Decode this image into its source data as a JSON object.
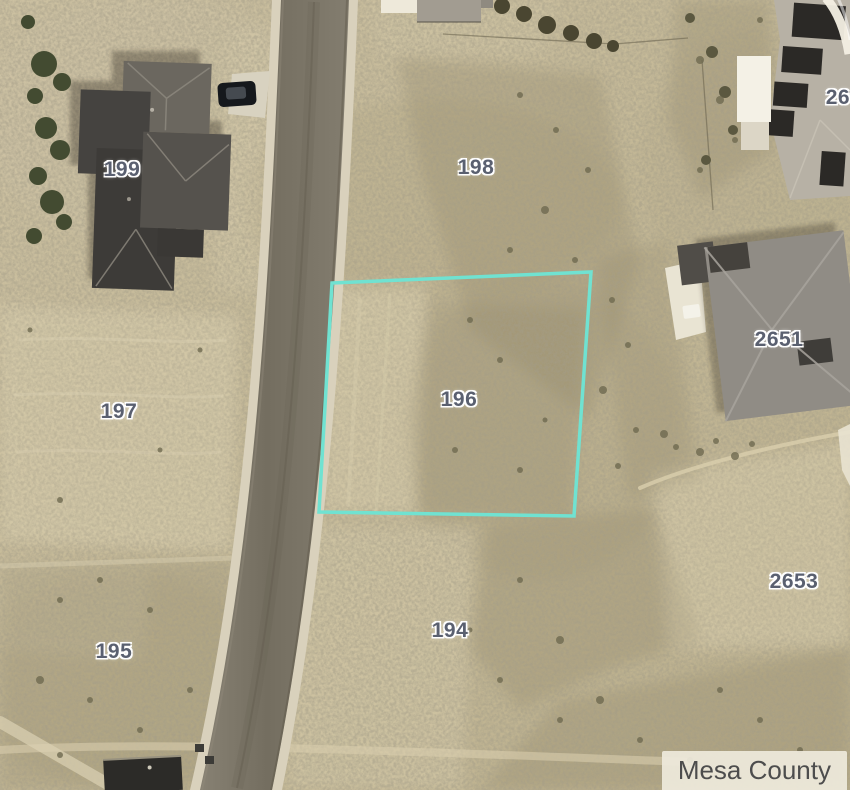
{
  "map": {
    "attribution": "Mesa County",
    "highlight": {
      "parcel_id": "196",
      "color": "#70e2d1"
    },
    "label_color": "#5a6070",
    "parcels": [
      {
        "id": "199"
      },
      {
        "id": "198"
      },
      {
        "id": "265"
      },
      {
        "id": "2651"
      },
      {
        "id": "197"
      },
      {
        "id": "196"
      },
      {
        "id": "2653"
      },
      {
        "id": "195"
      },
      {
        "id": "194"
      }
    ]
  }
}
